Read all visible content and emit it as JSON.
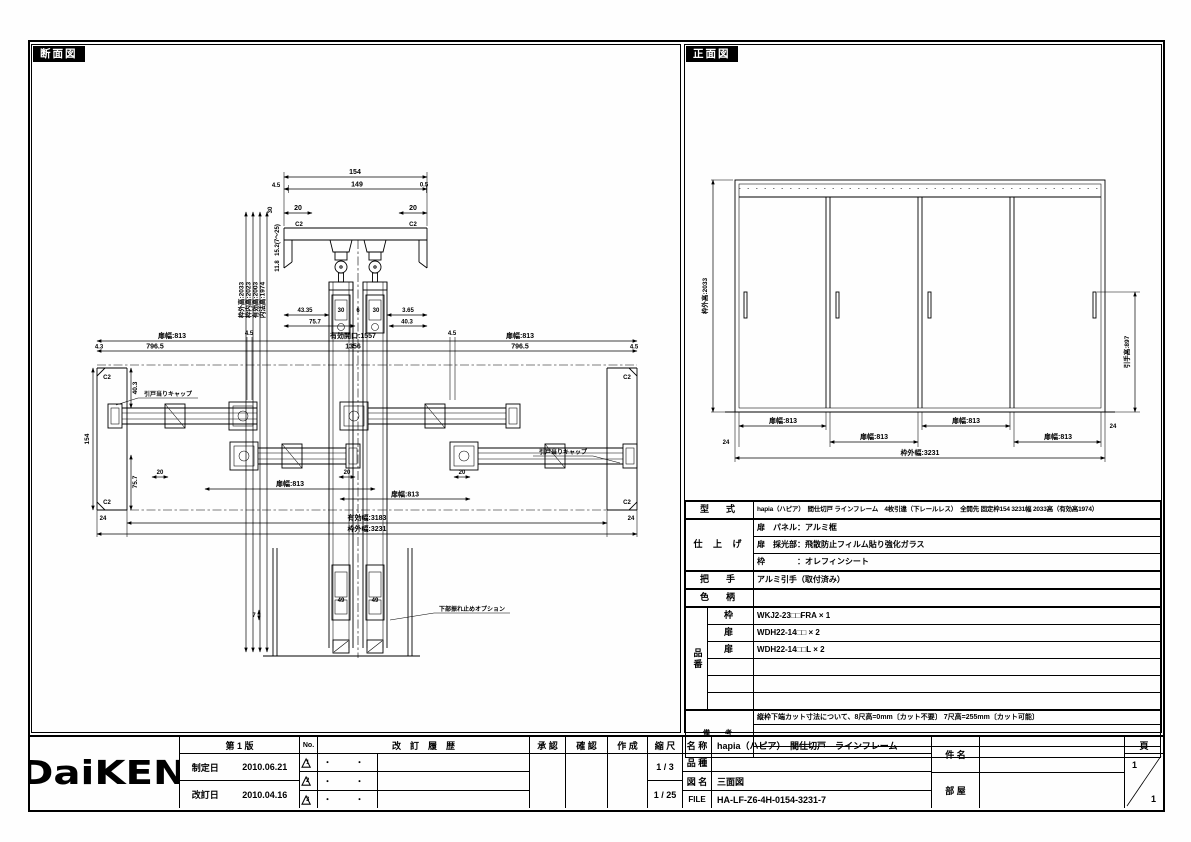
{
  "page": {
    "section_title": "断面図",
    "front_title": "正面図"
  },
  "section": {
    "vert_dims": [
      "枠外高:2033",
      "枠内高:2023",
      "有効高:2003",
      "内法高:1974"
    ],
    "head": {
      "w_total": "154",
      "w_left": "4.5",
      "w_mid": "149",
      "w_right": "0.5",
      "d20": "20",
      "c2": "C2",
      "v1": "30",
      "v2": "15.2(7〜25)",
      "v3": "11.8",
      "b1": "43.35",
      "b2": "30",
      "b3": "6",
      "b4": "30",
      "b5": "3.65",
      "b6": "75.7",
      "b7": "40.3"
    },
    "plan": {
      "door_w": "扉幅:813",
      "opening": "有効開口:1557",
      "mid_w": "1356",
      "gap": "4.5",
      "edge": "4.3",
      "half": "796.5",
      "jamb_v1": "40.3",
      "jamb_depth": "154",
      "jamb_v2": "75.7",
      "d20": "20",
      "eff_w": "有効幅:3183",
      "frame_w": "枠外幅:3231",
      "m24": "24",
      "c2": "C2",
      "cap_label": "引戸当りキャップ"
    },
    "bottom": {
      "w49": "49",
      "h7": "7",
      "option_label": "下部振れ止めオプション"
    }
  },
  "front": {
    "height_dim": "枠外高:2033",
    "handle_dim": "引手高:897",
    "door_w": "扉幅:813",
    "frame_w": "枠外幅:3231",
    "m24": "24"
  },
  "spec": {
    "model_label": "型　式",
    "model": "hapia（ハピア）　間仕切戸 ラインフレーム　4枚引違（下レールレス）　全開先 固定枠154 3231幅 2033高（有効高1974）",
    "finish_label": "仕 上 げ",
    "finish_rows": [
      "扉　パネル：アルミ框",
      "扉　採光部：飛散防止フィルム貼り強化ガラス",
      "枠　　　　：オレフィンシート"
    ],
    "handle_label": "把　手",
    "handle": "アルミ引手（取付済み）",
    "color_label": "色　柄",
    "color": "",
    "parts_label": "品番",
    "parts": [
      {
        "part": "枠",
        "code": "WKJ2-23□□FRA × 1"
      },
      {
        "part": "扉",
        "code": "WDH22-14□□ × 2"
      },
      {
        "part": "扉",
        "code": "WDH22-14□□L × 2"
      },
      {
        "part": "",
        "code": ""
      },
      {
        "part": "",
        "code": ""
      },
      {
        "part": "",
        "code": ""
      }
    ],
    "notes_label": "備　考",
    "notes": [
      "縦枠下端カット寸法について、8尺高=0mm〔カット不要〕 7尺高=255mm〔カット可能〕",
      "",
      "",
      ""
    ]
  },
  "titleblock": {
    "logo": "DaiKEN",
    "edition": "第 1 版",
    "established_label": "制定日",
    "established_date": "2010.06.21",
    "revised_label": "改訂日",
    "revised_date": "2010.04.16",
    "no_label": "No.",
    "history_label": "改　訂　履　歴",
    "revisions": [
      {
        "mark": "1",
        "date": "・　・",
        "desc": ""
      },
      {
        "mark": "2",
        "date": "・　・",
        "desc": ""
      },
      {
        "mark": "3",
        "date": "・　・",
        "desc": ""
      }
    ],
    "approval_label": "承 認",
    "check_label": "確 認",
    "create_label": "作 成",
    "scale_label": "縮 尺",
    "scale1": "1 / 3",
    "scale2": "1 / 25",
    "name_label": "名 称",
    "name": "hapia（ハピア）　間仕切戸　ラインフレーム",
    "kind_label": "品 種",
    "kind": "",
    "zumei_label": "図 名",
    "zumei": "三面図",
    "file_label": "FILE",
    "file": "HA-LF-Z6-4H-0154-3231-7",
    "kenmei_label": "件 名",
    "room_label": "部 屋",
    "page_label": "頁",
    "page_num": "1",
    "page_den": "1"
  }
}
